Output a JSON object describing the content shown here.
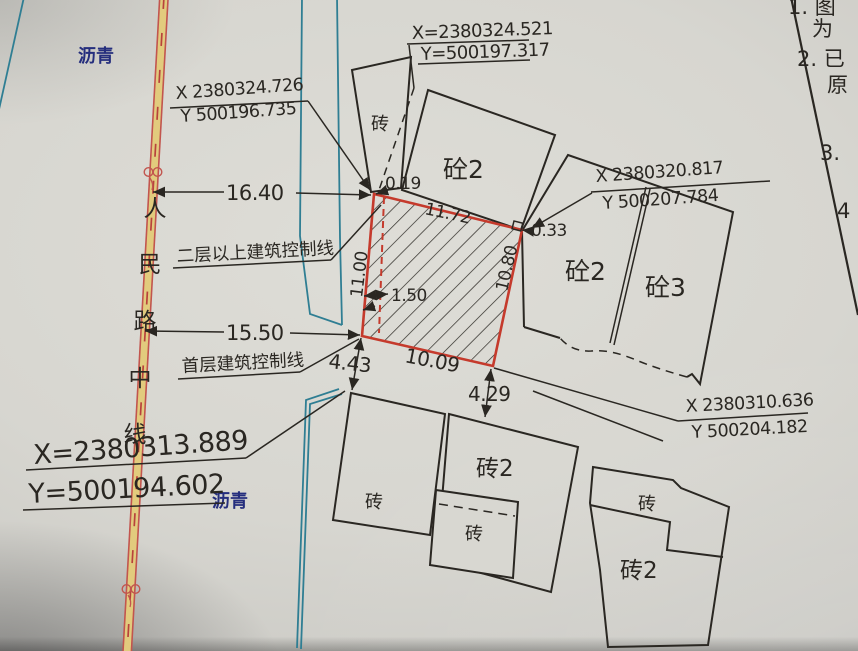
{
  "colors": {
    "paper": "#d8d7d1",
    "ink": "#2a2722",
    "parcel_red": "#c53a2c",
    "road_red": "#c2554e",
    "road_yellow": "#e2cb7d",
    "curb_cyan": "#2f7e93",
    "surface_navy": "#252e7d"
  },
  "road": {
    "chars": [
      "人",
      "民",
      "路",
      "中",
      "线"
    ],
    "surface_top": "沥青",
    "surface_bottom": "沥青"
  },
  "points": {
    "top": {
      "x": "X=2380324.521",
      "y": "Y=500197.317"
    },
    "nw": {
      "x": "X 2380324.726",
      "y": "Y 500196.735"
    },
    "ne": {
      "x": "X 2380320.817",
      "y": "Y 500207.784"
    },
    "se": {
      "x": "X 2380310.636",
      "y": "Y 500204.182"
    },
    "sw_road": {
      "x": "X=2380313.889",
      "y": "Y=500194.602"
    }
  },
  "dims": {
    "road_to_upper": "16.40",
    "road_to_ground": "15.50",
    "parcel_top": "11.72",
    "parcel_left": "11.00",
    "parcel_right": "10.80",
    "parcel_bottom": "10.09",
    "inner_offset": "1.50",
    "corner_nw_offset": "0.19",
    "corner_ne_offset": "0.33",
    "gap_sw": "4.43",
    "gap_se": "4.29"
  },
  "control_lines": {
    "upper": "二层以上建筑控制线",
    "ground": "首层建筑控制线"
  },
  "buildings": {
    "top_narrow": "砖",
    "top_large": "砼2",
    "east_a": "砼2",
    "east_b": "砼3",
    "south_west": "砖",
    "south_center": "砖2",
    "south_center_inner": "砖",
    "south_east_upper": "砖",
    "south_east_lower": "砖2"
  },
  "notes": [
    "1. 图",
    "为",
    "2. 已",
    "原",
    "3.",
    "4"
  ]
}
